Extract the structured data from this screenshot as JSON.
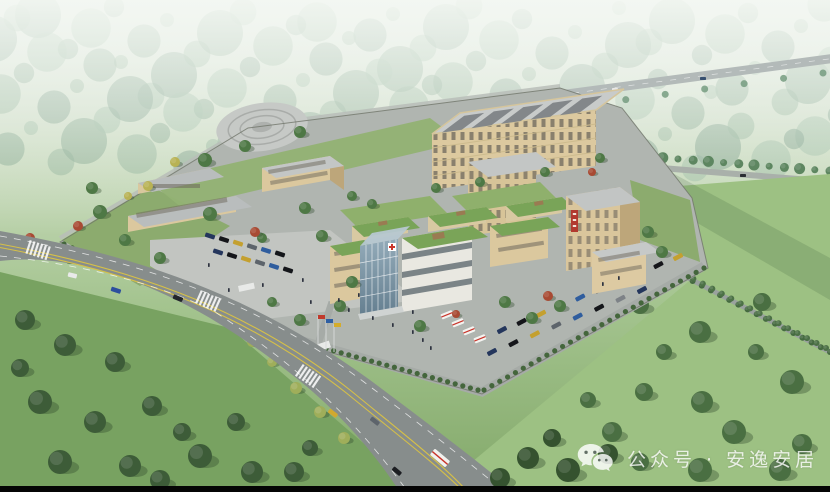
{
  "scene_type": "aerial-architectural-rendering",
  "watermark": {
    "icon": "wechat-icon",
    "text": "公众号 · 安逸安居"
  },
  "building_sign": {
    "color": "#b23a2f",
    "note_color_only": true
  },
  "colors": {
    "haze_white": "#eff4ef",
    "distant_forest_green": "#7fa68b",
    "right_field_green": "#9dc183",
    "left_field_green": "#78a261",
    "dark_tree_green": "#3d5c38",
    "campus_tree_green": "#4e7845",
    "autumn_red": "#a84a33",
    "autumn_yellow": "#b8b254",
    "road_gray": "#878d8c",
    "paving_gray": "#b5b9b5",
    "plaza_gray": "#c2c5c1",
    "building_tan": "#dbc89e",
    "building_tan_shade": "#bda67a",
    "roof_gray": "#c6c9c8",
    "roof_panel_gray": "#83878a",
    "glass_blue": "#7b95a6",
    "green_roof": "#79a458",
    "sign_red": "#b23a2f",
    "cross_red": "#c9352b",
    "ambulance_white": "#f3f3f0",
    "lane_yellow": "#d6c047",
    "flag_red": "#c0392b",
    "flag_blue": "#2e5fa3",
    "flag_yellow": "#d4ac2b",
    "watermark_white": "#ffffff",
    "bottom_bar_black": "#050505"
  }
}
